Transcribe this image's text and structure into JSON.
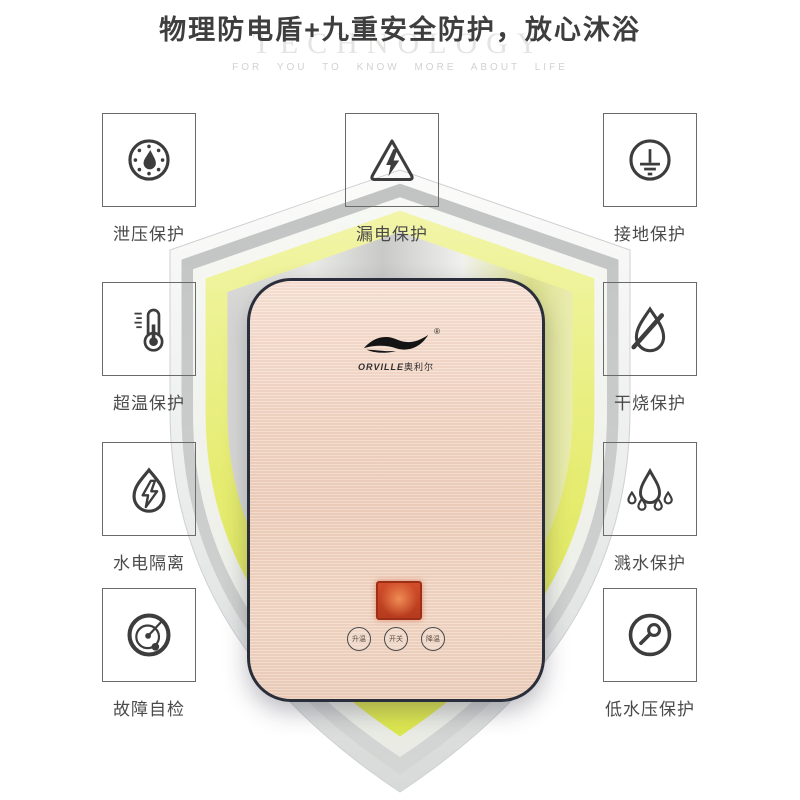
{
  "header": {
    "title": "物理防电盾+九重安全防护，放心沐浴",
    "watermark": "TECHNOLOGY",
    "tagline": "FOR YOU TO KNOW MORE ABOUT LIFE"
  },
  "features": {
    "left": [
      {
        "label": "泄压保护",
        "icon": "pressure-gauge-icon"
      },
      {
        "label": "超温保护",
        "icon": "thermometer-icon"
      },
      {
        "label": "水电隔离",
        "icon": "water-electric-icon"
      },
      {
        "label": "故障自检",
        "icon": "self-check-icon"
      }
    ],
    "center": [
      {
        "label": "漏电保护",
        "icon": "leakage-triangle-icon"
      }
    ],
    "right": [
      {
        "label": "接地保护",
        "icon": "grounding-icon"
      },
      {
        "label": "干烧保护",
        "icon": "dry-burn-icon"
      },
      {
        "label": "溅水保护",
        "icon": "splash-icon"
      },
      {
        "label": "低水压保护",
        "icon": "low-pressure-icon"
      }
    ]
  },
  "product": {
    "brand": "ORVILLE",
    "brand_cn": "奥利尔",
    "registered_mark": "®",
    "buttons": [
      "升温",
      "开关",
      "降温"
    ]
  },
  "colors": {
    "shield_yellow": "#e0e85f",
    "shield_gray": "#c9cbca",
    "panel_champagne": "#f3d7c8",
    "display_red": "#cf4a28",
    "title_text": "#3e3e3e"
  }
}
